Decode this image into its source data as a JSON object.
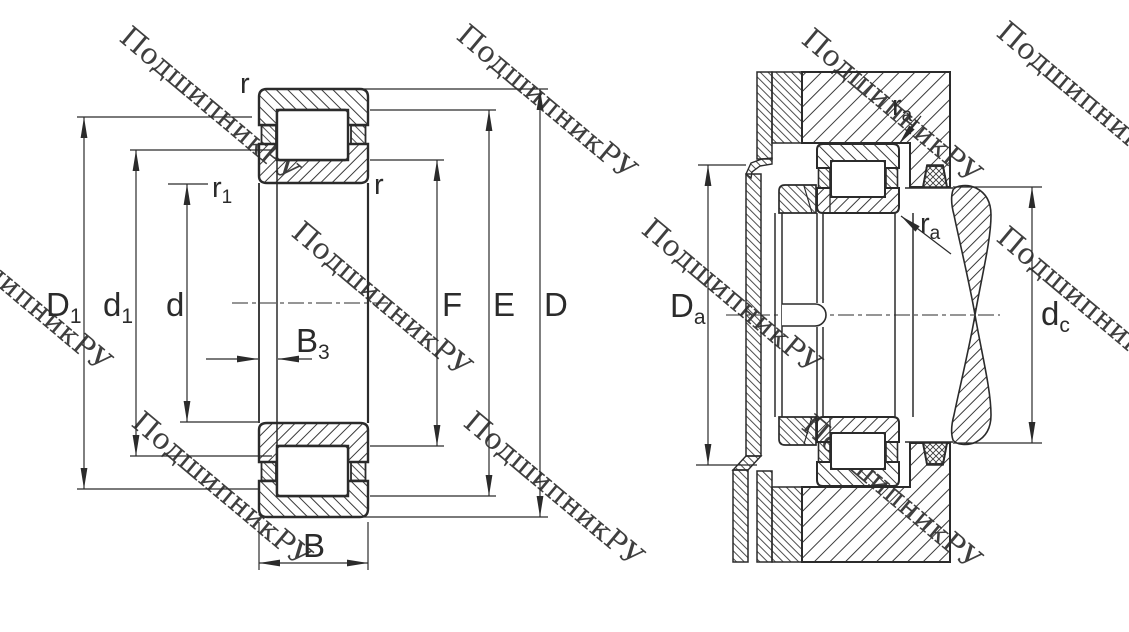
{
  "colors": {
    "line": "#2b2b2b",
    "hatch": "#3a3a3a",
    "watermark": "#c7c7c7",
    "background": "#ffffff"
  },
  "watermark": {
    "text": "ПодшипникРУ"
  },
  "left_view": {
    "labels": {
      "r_top": {
        "base": "r",
        "sub": ""
      },
      "r1": {
        "base": "r",
        "sub": "1"
      },
      "r_right": {
        "base": "r",
        "sub": ""
      },
      "D1": {
        "base": "D",
        "sub": "1"
      },
      "d1": {
        "base": "d",
        "sub": "1"
      },
      "d": {
        "base": "d",
        "sub": ""
      },
      "B3": {
        "base": "B",
        "sub": "3"
      },
      "B": {
        "base": "B",
        "sub": ""
      },
      "F": {
        "base": "F",
        "sub": ""
      },
      "E": {
        "base": "E",
        "sub": ""
      },
      "D": {
        "base": "D",
        "sub": ""
      }
    }
  },
  "right_view": {
    "labels": {
      "Da": {
        "base": "D",
        "sub": "a"
      },
      "dc": {
        "base": "d",
        "sub": "c"
      },
      "ra_top": {
        "base": "r",
        "sub": "a"
      },
      "ra_bottom": {
        "base": "r",
        "sub": "a"
      }
    }
  }
}
